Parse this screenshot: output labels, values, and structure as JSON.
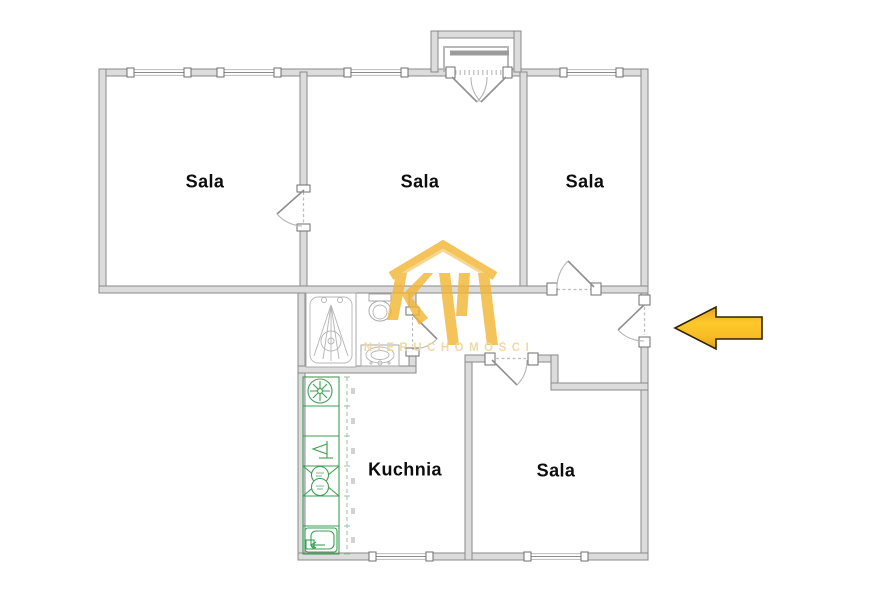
{
  "floor_plan": {
    "rooms": [
      {
        "id": "sala-top-left",
        "label": "Sala"
      },
      {
        "id": "sala-top-middle",
        "label": "Sala"
      },
      {
        "id": "sala-top-right",
        "label": "Sala"
      },
      {
        "id": "kuchnia",
        "label": "Kuchnia"
      },
      {
        "id": "sala-bottom-right",
        "label": "Sala"
      }
    ],
    "watermark": {
      "brand_initials": "KW",
      "text": "NIERUCHOMOŚCI",
      "logo_color": "#F2B637",
      "text_color": "#EFD7A3"
    },
    "entrance_arrow": {
      "direction": "left",
      "fill": "#FFC92B",
      "edge_fill": "#DF9F1E",
      "outline": "#2F2303"
    },
    "colors": {
      "background": "#FFFFFF",
      "wall_fill": "#DCDCDC",
      "wall_edge": "#8A8A8A",
      "kitchen_fixture_green": "#3E9E53",
      "label_text": "#0D0D0D"
    }
  }
}
